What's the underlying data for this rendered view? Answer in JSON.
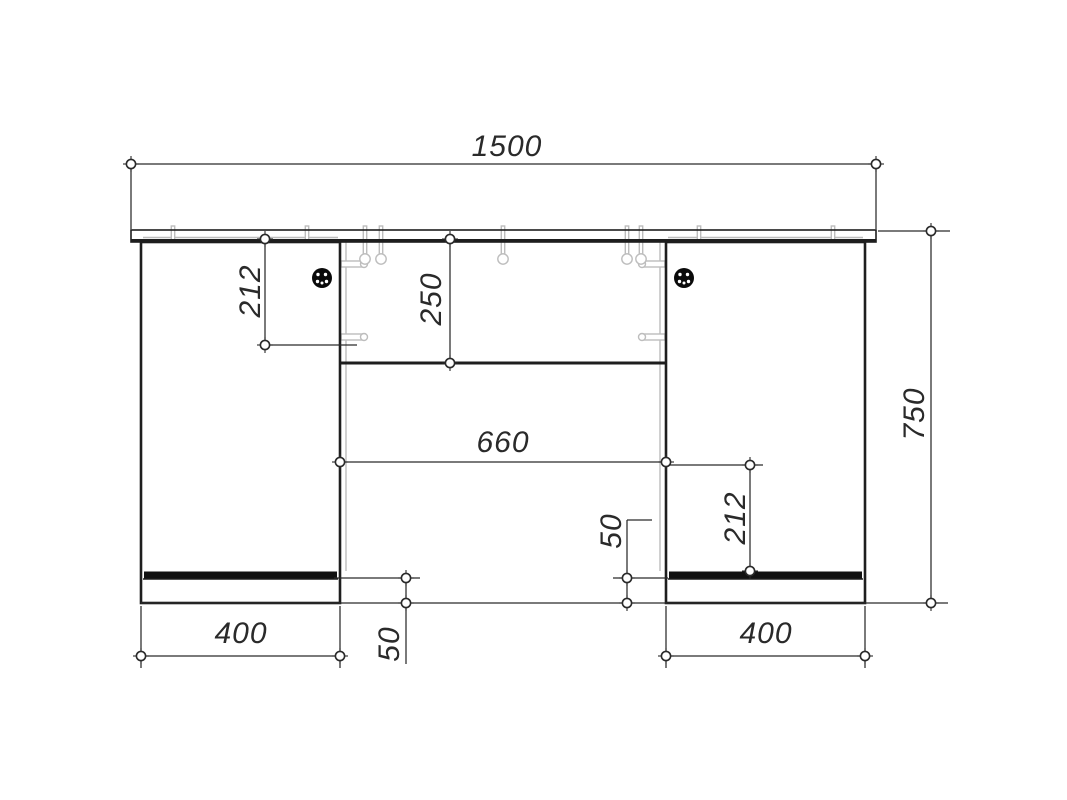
{
  "drawing": {
    "kind": "furniture-assembly-front-view",
    "units": "mm"
  },
  "dims": {
    "total_width": "1500",
    "overall_height": "750",
    "knee_space_width": "660",
    "upper_panel_height": "250",
    "left_shelf_offset": "212",
    "right_shelf_offset": "212",
    "left_plinth_height": "50",
    "right_plinth_height": "50",
    "left_pedestal_width": "400",
    "right_pedestal_width": "400"
  },
  "colors": {
    "line": "#1e1e1e",
    "dimension_line": "#2a2a2a",
    "hardware": "#bdbdbd",
    "background": "#ffffff"
  }
}
